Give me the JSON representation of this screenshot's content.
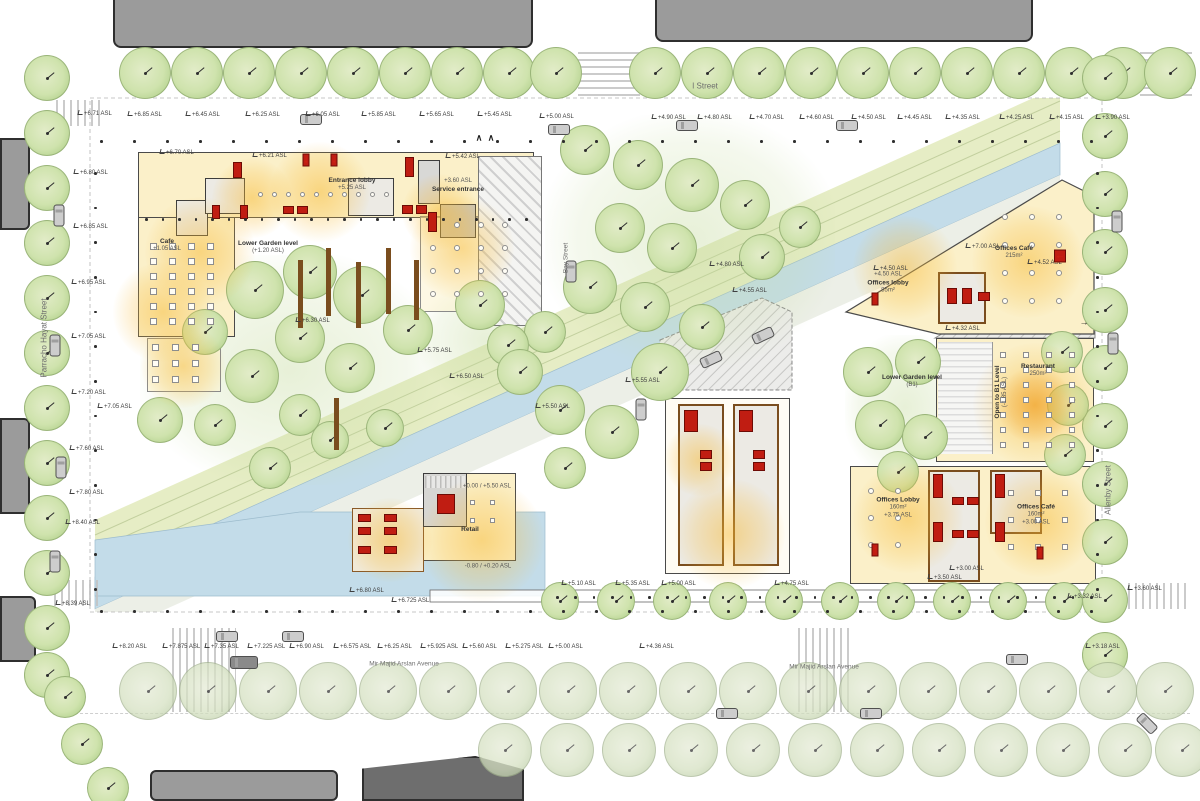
{
  "palette": {
    "floor_yellow": "#fbf0c9",
    "glow_orange": "#f7ba35",
    "water_blue": "#c3dce9",
    "grass_green": "#e6edc5",
    "tree_green": "#cfe3ad",
    "building_gray": "#9b9b9b",
    "core_red": "#c01d12",
    "wood_brown": "#7a4d1e"
  },
  "icons": {
    "down": "↓",
    "up": "↑",
    "left": "←",
    "right": "→",
    "chevron": "∧",
    "tree": "tree-icon",
    "car": "car-icon"
  },
  "streets": {
    "top": "I Street",
    "left": "Parracho Hayat Street",
    "center": "Bay Street",
    "right": "Allenby Street",
    "bottom": "Mir Majid Arslan Avenue"
  },
  "rooms": {
    "cafe": {
      "label": "Cafe",
      "elev": "+1.05 ASL"
    },
    "lower_garden": {
      "label": "Lower Garden level",
      "elev": "(+1.20 ASL)"
    },
    "entrance_lobby": {
      "label": "Entrance lobby",
      "elev": "+5.25 ASL"
    },
    "service_entrance": {
      "label": "Service entrance",
      "elev": "+3.60 ASL"
    },
    "offices_lobby_north": {
      "label": "Offices lobby",
      "area": "85m²",
      "elev": "+4.50 ASL"
    },
    "offices_cafe_north": {
      "label": "Offices Café",
      "area": "215m²"
    },
    "restaurant": {
      "label": "Restaurant",
      "area": "250m²"
    },
    "lower_garden_b1": {
      "label": "Lower Garden level",
      "sub": "(B1)"
    },
    "open_b1": {
      "label": "Open to B1 Level",
      "sub": "(-1.85 ASL)"
    },
    "offices_lobby_south": {
      "label": "Offices Lobby",
      "area": "160m²",
      "elev": "+3.75 ASL"
    },
    "offices_cafe_south": {
      "label": "Offices Café",
      "area": "160m²",
      "elev": "+3.00 ASL"
    },
    "retail": {
      "label": "Retail",
      "elev_upper": "+0.00 / +5.50 ASL",
      "elev_lower": "-0.80 / +0.20 ASL"
    }
  },
  "elevations": {
    "top_row": [
      "+6.85 ASL",
      "+6.45 ASL",
      "+6.25 ASL",
      "+6.05 ASL",
      "+5.85 ASL",
      "+5.65 ASL",
      "+5.45 ASL",
      "+5.00 ASL",
      "+4.90 ASL",
      "+4.80 ASL",
      "+4.70 ASL",
      "+4.60 ASL",
      "+4.50 ASL",
      "+4.45 ASL",
      "+4.35 ASL",
      "+4.25 ASL",
      "+4.15 ASL",
      "+3.90 ASL"
    ],
    "bottom_row": [
      "+8.20 ASL",
      "+7.875 ASL",
      "+7.35 ASL",
      "+7.225 ASL",
      "+6.90 ASL",
      "+6.575 ASL",
      "+6.25 ASL",
      "+5.925 ASL",
      "+5.60 ASL",
      "+5.275 ASL",
      "+5.00 ASL",
      "+4.36 ASL",
      "+3.18 ASL"
    ],
    "left_col": [
      "+6.71 ASL",
      "+6.80 ASL",
      "+6.85 ASL",
      "+6.95 ASL",
      "+7.05 ASL",
      "+7.20 ASL",
      "+7.60 ASL",
      "+7.80 ASL",
      "+8.40 ASL",
      "+8.39 ASL"
    ],
    "right_col": [
      "+3.60 ASL",
      "+3.32 ASL"
    ],
    "site_row": [
      "+6.80 ASL",
      "+6.725 ASL",
      "+5.10 ASL",
      "+5.35 ASL",
      "+5.00 ASL",
      "+4.75 ASL",
      "+3.50 ASL"
    ],
    "interior": [
      "+6.70 ASL",
      "+6.21 ASL",
      "+5.42 ASL",
      "+4.80 ASL",
      "+4.55 ASL",
      "+5.55 ASL",
      "+5.50 ASL",
      "+7.00 ASL",
      "+4.50 ASL",
      "+4.52 ASL",
      "+4.32 ASL",
      "+5.75 ASL",
      "+6.50 ASL",
      "+7.05 ASL",
      "+6.30 ASL",
      "+3.00 ASL"
    ]
  }
}
